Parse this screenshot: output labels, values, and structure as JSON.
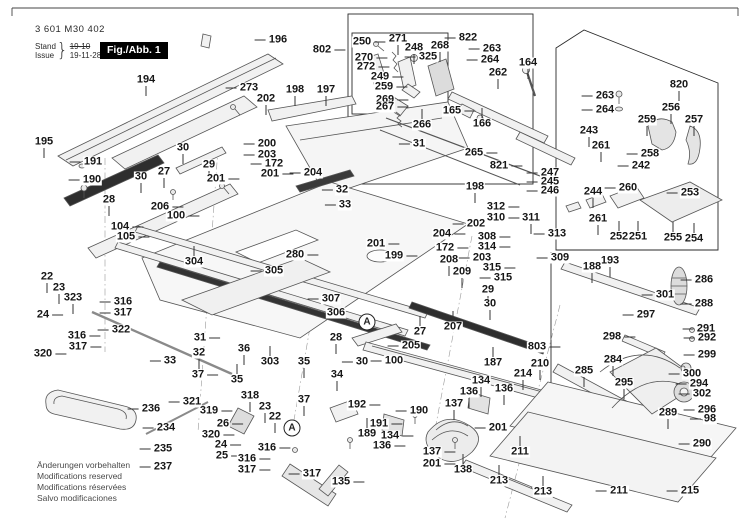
{
  "header": {
    "part_no": "3 601 M30 402",
    "stand_label": "Stand",
    "issue_label": "Issue",
    "stand_value": "19-10",
    "issue_value": "19-11-28",
    "figure_label": "Fig./Abb. 1"
  },
  "footer": {
    "lines": [
      "Änderungen vorbehalten",
      "Modifications reserved",
      "Modifications réservées",
      "Salvo modificaciones"
    ]
  },
  "colors": {
    "label_text": "#161616",
    "line": "#555555",
    "box": "#2a2a2a",
    "fig_box_bg": "#000000",
    "fig_box_text": "#ffffff",
    "footer_text": "#4a4a4a"
  },
  "detail_markers": [
    {
      "t": "A",
      "x": 367,
      "y": 322
    },
    {
      "t": "A",
      "x": 292,
      "y": 428
    }
  ],
  "labels": [
    [
      "196",
      278,
      40,
      "l"
    ],
    [
      "802",
      322,
      50,
      "r"
    ],
    [
      "250",
      362,
      42,
      "r"
    ],
    [
      "271",
      398,
      39,
      "d"
    ],
    [
      "248",
      414,
      48,
      "d"
    ],
    [
      "268",
      440,
      46,
      "d"
    ],
    [
      "822",
      468,
      38,
      "l"
    ],
    [
      "263",
      492,
      49,
      "l"
    ],
    [
      "264",
      490,
      60,
      "l"
    ],
    [
      "164",
      528,
      63,
      "d"
    ],
    [
      "820",
      679,
      85,
      "d"
    ],
    [
      "194",
      146,
      80,
      "d"
    ],
    [
      "273",
      249,
      88,
      "l"
    ],
    [
      "325",
      428,
      57,
      "l"
    ],
    [
      "270",
      364,
      58,
      "r"
    ],
    [
      "272",
      366,
      67,
      "r"
    ],
    [
      "249",
      380,
      77,
      "r"
    ],
    [
      "259",
      384,
      87,
      "r"
    ],
    [
      "262",
      498,
      73,
      "d"
    ],
    [
      "263",
      605,
      96,
      "l"
    ],
    [
      "256",
      671,
      108,
      "d"
    ],
    [
      "264",
      605,
      110,
      "l"
    ],
    [
      "259",
      647,
      120,
      "d"
    ],
    [
      "257",
      694,
      120,
      "d"
    ],
    [
      "202",
      266,
      99,
      "d"
    ],
    [
      "198",
      295,
      90,
      "d"
    ],
    [
      "197",
      326,
      90,
      "d"
    ],
    [
      "269",
      385,
      100,
      "r"
    ],
    [
      "267",
      385,
      107,
      "r"
    ],
    [
      "165",
      452,
      111,
      "r"
    ],
    [
      "266",
      422,
      125,
      "u"
    ],
    [
      "166",
      482,
      124,
      "u"
    ],
    [
      "243",
      589,
      131,
      "d"
    ],
    [
      "261",
      601,
      146,
      "d"
    ],
    [
      "258",
      650,
      154,
      "l"
    ],
    [
      "242",
      641,
      166,
      "l"
    ],
    [
      "195",
      44,
      142,
      "d"
    ],
    [
      "30",
      183,
      148,
      "d"
    ],
    [
      "191",
      93,
      162,
      "l"
    ],
    [
      "190",
      92,
      180,
      "l"
    ],
    [
      "27",
      164,
      172,
      "d"
    ],
    [
      "29",
      209,
      165,
      "d"
    ],
    [
      "30",
      141,
      177,
      "d"
    ],
    [
      "200",
      267,
      144,
      "l"
    ],
    [
      "203",
      267,
      155,
      "l"
    ],
    [
      "172",
      274,
      164,
      "l"
    ],
    [
      "204",
      313,
      173,
      "l"
    ],
    [
      "201",
      270,
      174,
      "r"
    ],
    [
      "31",
      419,
      144,
      "l"
    ],
    [
      "265",
      474,
      153,
      "r"
    ],
    [
      "821",
      499,
      166,
      "r"
    ],
    [
      "247",
      550,
      173,
      "l"
    ],
    [
      "245",
      550,
      182,
      "l"
    ],
    [
      "246",
      550,
      191,
      "l"
    ],
    [
      "244",
      593,
      192,
      "d"
    ],
    [
      "260",
      628,
      188,
      "l"
    ],
    [
      "253",
      690,
      193,
      "l"
    ],
    [
      "28",
      109,
      200,
      "d"
    ],
    [
      "206",
      160,
      207,
      "r"
    ],
    [
      "100",
      176,
      216,
      "r"
    ],
    [
      "104",
      120,
      227,
      "r"
    ],
    [
      "105",
      126,
      237,
      "r"
    ],
    [
      "201",
      216,
      179,
      "r"
    ],
    [
      "198",
      475,
      187,
      "d"
    ],
    [
      "261",
      598,
      219,
      "d"
    ],
    [
      "252",
      619,
      237,
      "u"
    ],
    [
      "251",
      638,
      237,
      "u"
    ],
    [
      "255",
      673,
      238,
      "u"
    ],
    [
      "254",
      694,
      239,
      "u"
    ],
    [
      "312",
      496,
      207,
      "r"
    ],
    [
      "310",
      496,
      218,
      "r"
    ],
    [
      "311",
      531,
      218,
      "d"
    ],
    [
      "202",
      476,
      224,
      "l"
    ],
    [
      "204",
      442,
      234,
      "r"
    ],
    [
      "308",
      487,
      237,
      "r"
    ],
    [
      "314",
      487,
      247,
      "r"
    ],
    [
      "172",
      445,
      248,
      "r"
    ],
    [
      "203",
      482,
      258,
      "l"
    ],
    [
      "208",
      449,
      260,
      "d"
    ],
    [
      "209",
      462,
      272,
      "d"
    ],
    [
      "315",
      492,
      268,
      "r"
    ],
    [
      "315",
      503,
      278,
      "l"
    ],
    [
      "201",
      376,
      244,
      "r"
    ],
    [
      "199",
      394,
      256,
      "r"
    ],
    [
      "313",
      557,
      234,
      "l"
    ],
    [
      "309",
      560,
      258,
      "l"
    ],
    [
      "193",
      610,
      261,
      "d"
    ],
    [
      "188",
      592,
      267,
      "d"
    ],
    [
      "304",
      194,
      262,
      "u"
    ],
    [
      "280",
      295,
      255,
      "r"
    ],
    [
      "305",
      274,
      271,
      "l"
    ],
    [
      "32",
      342,
      190,
      "l"
    ],
    [
      "33",
      345,
      205,
      "l"
    ],
    [
      "22",
      47,
      277,
      "d"
    ],
    [
      "23",
      59,
      288,
      "d"
    ],
    [
      "323",
      73,
      298,
      "d"
    ],
    [
      "24",
      43,
      315,
      "r"
    ],
    [
      "316",
      123,
      302,
      "l"
    ],
    [
      "317",
      123,
      313,
      "l"
    ],
    [
      "322",
      121,
      330,
      "l"
    ],
    [
      "316",
      77,
      336,
      "r"
    ],
    [
      "317",
      78,
      347,
      "r"
    ],
    [
      "320",
      43,
      354,
      "r"
    ],
    [
      "33",
      170,
      361,
      "l"
    ],
    [
      "307",
      331,
      299,
      "l"
    ],
    [
      "306",
      336,
      313,
      "l"
    ],
    [
      "29",
      488,
      290,
      "d"
    ],
    [
      "30",
      490,
      304,
      "d"
    ],
    [
      "27",
      420,
      332,
      "u"
    ],
    [
      "207",
      453,
      327,
      "u"
    ],
    [
      "205",
      411,
      346,
      "l"
    ],
    [
      "803",
      537,
      347,
      "r"
    ],
    [
      "286",
      704,
      280,
      "l"
    ],
    [
      "301",
      665,
      295,
      "l"
    ],
    [
      "288",
      704,
      304,
      "l"
    ],
    [
      "297",
      646,
      315,
      "l"
    ],
    [
      "291",
      706,
      329,
      "l"
    ],
    [
      "292",
      707,
      338,
      "l"
    ],
    [
      "298",
      612,
      337,
      "r"
    ],
    [
      "299",
      707,
      355,
      "l"
    ],
    [
      "31",
      200,
      338,
      "r"
    ],
    [
      "36",
      244,
      349,
      "d"
    ],
    [
      "28",
      336,
      338,
      "d"
    ],
    [
      "303",
      270,
      362,
      "u"
    ],
    [
      "32",
      199,
      353,
      "d"
    ],
    [
      "35",
      304,
      362,
      "d"
    ],
    [
      "30",
      362,
      362,
      "l"
    ],
    [
      "34",
      337,
      375,
      "d"
    ],
    [
      "35",
      237,
      380,
      "u"
    ],
    [
      "37",
      198,
      375,
      "r"
    ],
    [
      "37",
      304,
      400,
      "d"
    ],
    [
      "284",
      613,
      360,
      "d"
    ],
    [
      "285",
      584,
      371,
      "d"
    ],
    [
      "295",
      624,
      383,
      "d"
    ],
    [
      "300",
      692,
      374,
      "l"
    ],
    [
      "294",
      699,
      384,
      "l"
    ],
    [
      "302",
      702,
      394,
      "l"
    ],
    [
      "296",
      707,
      410,
      "l"
    ],
    [
      "98",
      710,
      419,
      "l"
    ],
    [
      "289",
      668,
      413,
      "d"
    ],
    [
      "290",
      702,
      444,
      "l"
    ],
    [
      "321",
      192,
      402,
      "l"
    ],
    [
      "319",
      209,
      411,
      "r"
    ],
    [
      "26",
      223,
      424,
      "r"
    ],
    [
      "318",
      250,
      396,
      "d"
    ],
    [
      "23",
      265,
      407,
      "d"
    ],
    [
      "22",
      275,
      417,
      "d"
    ],
    [
      "320",
      211,
      435,
      "r"
    ],
    [
      "24",
      221,
      445,
      "r"
    ],
    [
      "25",
      222,
      456,
      "r"
    ],
    [
      "316",
      267,
      448,
      "r"
    ],
    [
      "316",
      247,
      459,
      "r"
    ],
    [
      "317",
      247,
      470,
      "r"
    ],
    [
      "317",
      312,
      474,
      "l"
    ],
    [
      "135",
      341,
      482,
      "r"
    ],
    [
      "100",
      394,
      361,
      "l"
    ],
    [
      "187",
      493,
      363,
      "u"
    ],
    [
      "210",
      540,
      364,
      "d"
    ],
    [
      "214",
      523,
      374,
      "d"
    ],
    [
      "192",
      357,
      405,
      "r"
    ],
    [
      "190",
      419,
      411,
      "l"
    ],
    [
      "191",
      379,
      424,
      "r"
    ],
    [
      "189",
      367,
      434,
      "u"
    ],
    [
      "134",
      390,
      436,
      "r"
    ],
    [
      "136",
      382,
      446,
      "r"
    ],
    [
      "134",
      481,
      381,
      "d"
    ],
    [
      "136",
      469,
      392,
      "d"
    ],
    [
      "136",
      504,
      389,
      "d"
    ],
    [
      "137",
      454,
      404,
      "d"
    ],
    [
      "137",
      432,
      452,
      "r"
    ],
    [
      "201",
      432,
      464,
      "r"
    ],
    [
      "201",
      498,
      428,
      "l"
    ],
    [
      "138",
      463,
      470,
      "u"
    ],
    [
      "236",
      151,
      409,
      "l"
    ],
    [
      "234",
      166,
      428,
      "l"
    ],
    [
      "235",
      163,
      449,
      "l"
    ],
    [
      "237",
      163,
      467,
      "l"
    ],
    [
      "211",
      520,
      452,
      "u"
    ],
    [
      "213",
      499,
      481,
      "u"
    ],
    [
      "213",
      543,
      492,
      "u"
    ],
    [
      "211",
      619,
      491,
      "l"
    ],
    [
      "215",
      690,
      491,
      "l"
    ]
  ]
}
